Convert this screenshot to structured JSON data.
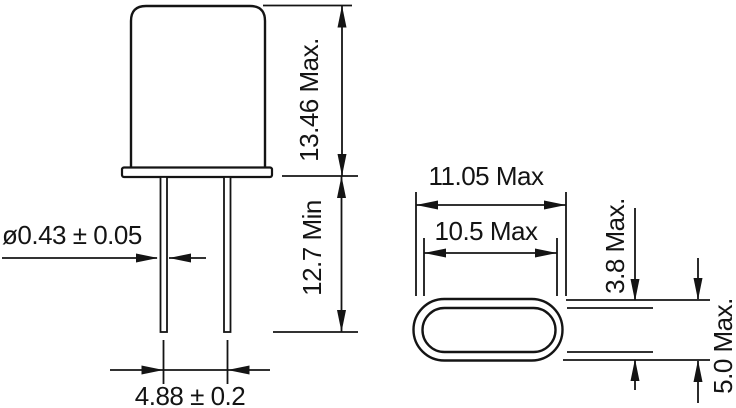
{
  "figure": {
    "description": "crystal-package-mechanical-drawing",
    "line_color": "#141414",
    "background_color": "#ffffff",
    "side_view": {
      "body_height": "13.46 Max.",
      "lead_length": "12.7 Min",
      "lead_diameter": "ø0.43 ± 0.05",
      "lead_spacing": "4.88 ± 0.2"
    },
    "top_view": {
      "outer_length": "11.05 Max",
      "inner_length": "10.5 Max",
      "inner_width": "3.8 Max.",
      "outer_width": "5.0 Max."
    }
  }
}
